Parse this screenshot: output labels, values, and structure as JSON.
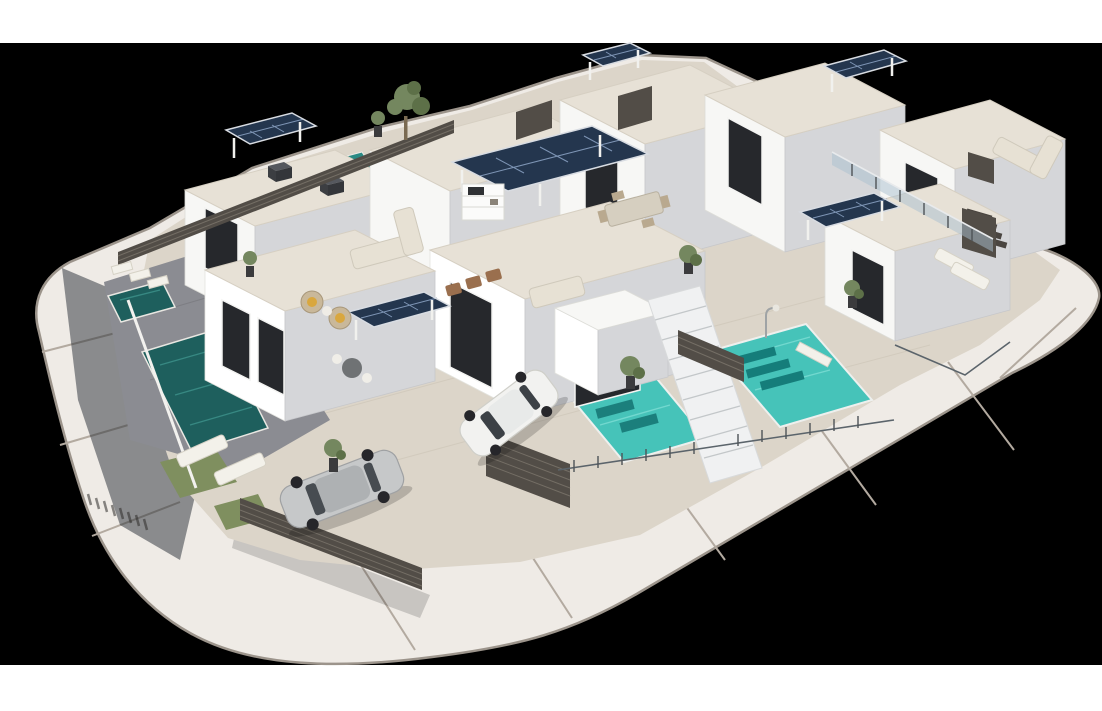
{
  "meta": {
    "image_type": "architectural-3d-render",
    "description": "Aerial 3D render of a modern white villa development on a rounded rectangular plot ringed by a light concrete road, letterboxed on a black background with white bands at top and bottom. The complex has flat-roofed white villas with beige paved roof terraces, blue solar-panel pergolas, turquoise private pools, sun loungers, outdoor lounge and dining furniture, dark slatted fences and gates, glass railings, an exterior staircase, one white car and one silver car parked in front yards, and potted plants and one tall tree."
  },
  "canvas": {
    "width": 1102,
    "height": 711,
    "letterbox_top_band_px": 43,
    "letterbox_bottom_band_px": 46
  },
  "palette": {
    "margin_white": "#ffffff",
    "background": "#000000",
    "road": "#efebe6",
    "road_joint": "#b3aaa0",
    "curb": "#9c948b",
    "parcel_paving": "#dcd5c9",
    "gray_paving": "#8b8c92",
    "wall_white": "#f7f7f5",
    "wall_shade": "#d5d6d9",
    "roof_stone": "#e7e1d6",
    "solar_panel": "#24364e",
    "solar_grid": "#7e95b5",
    "pool_dark": "#1e5f5d",
    "pool_bright": "#46c3b9",
    "fence_dark": "#524d47",
    "window_dark": "#26282c",
    "glass_railing": "#a9bfd0",
    "plant_green": "#74875f",
    "lawn_green": "#7f8f5f",
    "car_white": "#f2f2f0",
    "car_silver": "#c6c8c9",
    "furniture_beige": "#e7e1d4",
    "cushion_yellow": "#d9a73e",
    "shadow_blue": "#252b33"
  },
  "scene": {
    "setting": "sunny daylight, shadows cast toward lower-left",
    "elements": [
      {
        "name": "perimeter-road",
        "count": 1,
        "color": "#efebe6",
        "note": "rounded-corner ring road with 9 expansion joints"
      },
      {
        "name": "building-mass",
        "count": 9,
        "color": "#f7f7f5",
        "note": "flat-roofed white villas, two rows"
      },
      {
        "name": "solar-pergola",
        "count": 6,
        "color": "#24364e"
      },
      {
        "name": "swimming-pool",
        "count": 5,
        "colors": [
          "#1e5f5d",
          "#46c3b9"
        ],
        "note": "two dark teal on left yard, two bright turquoise at front, one small at rear"
      },
      {
        "name": "car",
        "count": 2,
        "colors": [
          "#f2f2f0",
          "#c6c8c9"
        ],
        "note": "white car in centre driveway, silver car in left front yard"
      },
      {
        "name": "sun-lounger",
        "count": 9
      },
      {
        "name": "sofa-set",
        "count": 3
      },
      {
        "name": "dining-set",
        "count": 2
      },
      {
        "name": "wicker-chair",
        "count": 2,
        "cushion": "#d9a73e"
      },
      {
        "name": "bistro-table",
        "count": 1
      },
      {
        "name": "outdoor-kitchen",
        "count": 1
      },
      {
        "name": "slat-fence-or-gate",
        "count": 7,
        "color": "#524d47"
      },
      {
        "name": "glass-railing",
        "count": 1
      },
      {
        "name": "wire-railing",
        "count": 2
      },
      {
        "name": "staircase",
        "count": 2
      },
      {
        "name": "street-lamp",
        "count": 1
      },
      {
        "name": "tree",
        "count": 1
      },
      {
        "name": "potted-plant",
        "count": 6
      },
      {
        "name": "lawn-patch",
        "count": 2
      }
    ]
  }
}
